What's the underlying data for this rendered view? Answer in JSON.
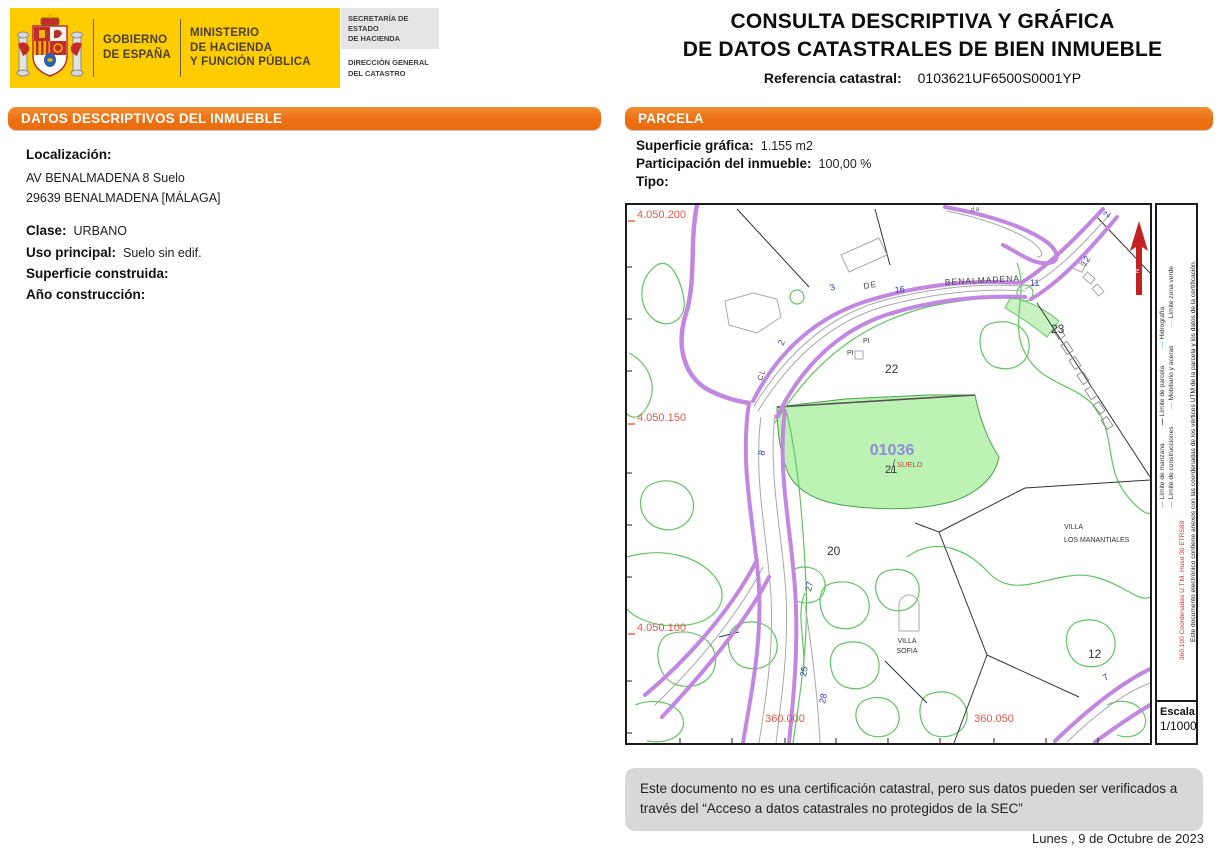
{
  "document": {
    "title_line1": "CONSULTA DESCRIPTIVA Y GRÁFICA",
    "title_line2": "DE DATOS CATASTRALES DE BIEN INMUEBLE",
    "ref_label": "Referencia catastral:",
    "ref_value": "0103621UF6500S0001YP",
    "disclaimer": "Este documento no es una certificación catastral, pero sus datos pueden ser verificados a través del “Acceso a datos catastrales no protegidos de la SEC”",
    "date": "Lunes , 9 de Octubre de 2023"
  },
  "logo": {
    "gobierno_l1": "GOBIERNO",
    "gobierno_l2": "DE ESPAÑA",
    "ministerio_l1": "MINISTERIO",
    "ministerio_l2": "DE HACIENDA",
    "ministerio_l3": "Y FUNCIÓN PÚBLICA",
    "secretaria_l1": "SECRETARÍA DE ESTADO",
    "secretaria_l2": "DE HACIENDA",
    "direccion_l1": "DIRECCIÓN GENERAL",
    "direccion_l2": "DEL CATASTRO"
  },
  "left_panel": {
    "header": "DATOS DESCRIPTIVOS DEL INMUEBLE",
    "localizacion_label": "Localización:",
    "address_line1": "AV BENALMADENA 8 Suelo",
    "address_line2": "29639 BENALMADENA [MÁLAGA]",
    "fields": [
      {
        "label": "Clase:",
        "value": "URBANO"
      },
      {
        "label": "Uso principal:",
        "value": "Suelo sin edif."
      },
      {
        "label": "Superficie construida:",
        "value": ""
      },
      {
        "label": "Año construcción:",
        "value": ""
      }
    ]
  },
  "parcel_panel": {
    "header": "PARCELA",
    "fields": [
      {
        "label": "Superficie gráfica:",
        "value": "1.155 m2"
      },
      {
        "label": "Participación del inmueble:",
        "value": "100,00 %"
      },
      {
        "label": "Tipo:",
        "value": ""
      }
    ]
  },
  "map": {
    "grid": {
      "y1": "4.050.200",
      "y2": "4.050.150",
      "y3": "4.050.100",
      "x1": "360.000",
      "x2": "360.050"
    },
    "parcel": {
      "code": "01036",
      "use": "SUELO",
      "number": "21"
    },
    "parcel_numbers": {
      "n20": "20",
      "n22": "22",
      "n23": "23",
      "n12": "12"
    },
    "streets": {
      "de": "DE",
      "benalmadena": "BENALMADENA",
      "cl": "CL",
      "top_fragment": "da"
    },
    "houses": {
      "h3": "3",
      "h16": "16",
      "h11": "11",
      "h12": "12",
      "h2a": "2",
      "h2b": "2",
      "h8": "8",
      "h27": "27",
      "h25": "25",
      "h28": "28",
      "h7": "7"
    },
    "pois": {
      "pi1": "PI",
      "pi2": "PI",
      "villa1_l1": "VILLA",
      "villa1_l2": "SOFIA",
      "villa2_l1": "VILLA",
      "villa2_l2": "LOS MANANTIALES"
    },
    "colors": {
      "manzana_purple": "#c287e0",
      "zona_verde_green": "#62c462",
      "parcel_fill": "#bdf2b5",
      "grid_label_red": "#e05a4a",
      "house_number_blue": "#2e3bbf",
      "parcel_code_lavender": "#8c8cd9",
      "suelo_red": "#cc4433"
    }
  },
  "legend": {
    "dash": "—",
    "entries": [
      {
        "label": "Límite de manzana"
      },
      {
        "label": "Límite de construcciones"
      },
      {
        "label": "Límite de parcela"
      },
      {
        "label": "Mobiliario y aceras"
      },
      {
        "label": "Hidrografía"
      },
      {
        "label": "Límite zona verde"
      }
    ],
    "coords_note": "360.100 Coordenadas U.T.M. Huso 30 ETRS89",
    "cert_note": "Este documento electrónico contiene anexos con las coordenadas de los vértices UTM de la parcela y los datos de la certificación.",
    "escala_label": "Escala:",
    "escala_value": "1/1000"
  },
  "accent_colors": {
    "orange": "#ed7014",
    "yellow": "#ffcc00",
    "footer_gray": "#d8d8d8"
  }
}
